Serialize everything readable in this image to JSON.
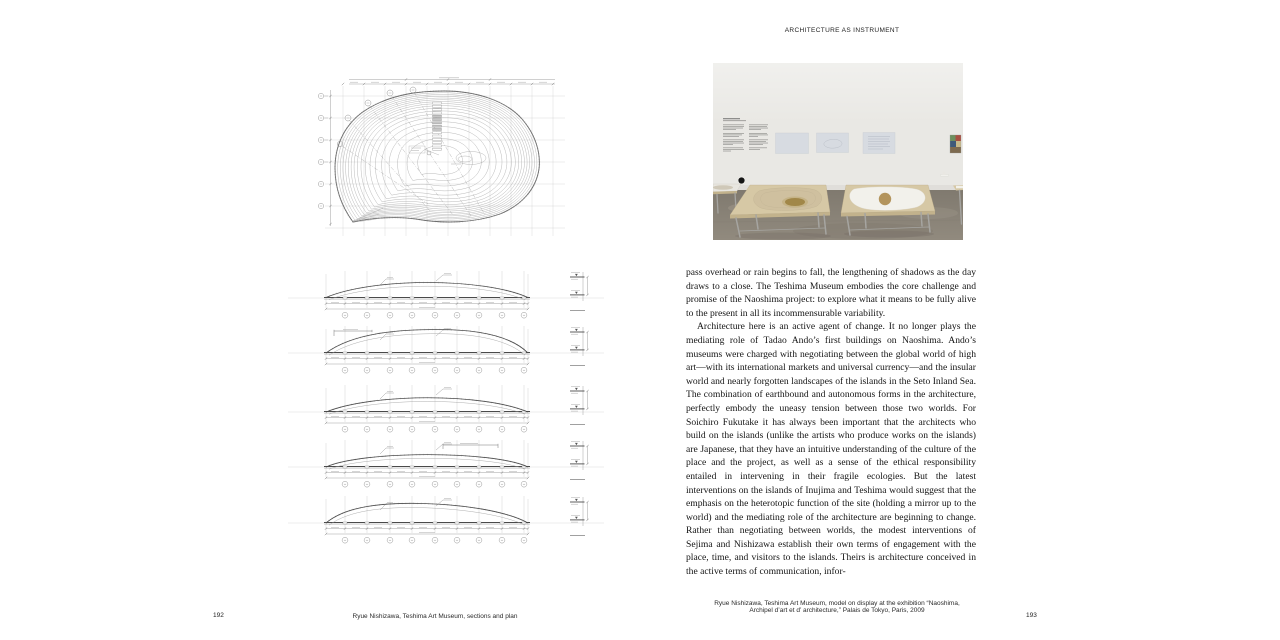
{
  "left_page": {
    "page_number": "192",
    "caption": "Ryue Nishizawa, Teshima Art Museum, sections and plan",
    "figures": {
      "plan_count": 1,
      "section_count": 5
    }
  },
  "right_page": {
    "running_head": "ARCHITECTURE AS INSTRUMENT",
    "page_number": "193",
    "photo_caption": {
      "line1": "Ryue Nishizawa, Teshima Art Museum, model on display at the exhibition “Naoshima,",
      "line2": "Archipel d’art et d’ architecture,” Palais de Tokyo, Paris, 2009"
    },
    "body": {
      "paragraph1": "pass overhead or rain begins to fall, the lengthening of shadows as the day draws to a close. The Teshima Museum embodies the core challenge and promise of the Naoshima project: to explore what it means to be fully alive to the present in all its incommensurable variability.",
      "paragraph2": "Architecture here is an active agent of change. It no longer plays the mediating role of Tadao Ando’s first buildings on Naoshima. Ando’s museums were charged with negotiating between the global world of high art—with its international markets and universal currency—and the insular world and nearly forgotten landscapes of the islands in the Seto Inland Sea. The combination of earthbound and autonomous forms in the architecture, perfectly embody the uneasy tension between those two worlds. For Soichiro Fukutake it has always been important that the architects who build on the islands (unlike the artists who produce works on the islands) are Japanese, that they have an intuitive understanding of the culture of the place and the project, as well as a sense of the ethical responsibility entailed in intervening in their fragile ecologies. But the latest interventions on the islands of Inujima and Teshima would suggest that the emphasis on the heterotopic function of the site (holding a mirror up to the world) and the mediating role of the architecture are beginning to change. Rather than negotiating between worlds, the modest interventions of Sejima and Nishizawa establish their own terms of engagement with the place, time, and visitors to the islands. Theirs is architecture conceived in the active terms of communication, infor-"
    }
  },
  "photo": {
    "colors": {
      "wall": "#e9e8e4",
      "wall_shade": "#d8d6d1",
      "floor": "#918a7e",
      "floor_light": "#a39b8f",
      "floor_dark": "#7f786e",
      "plywood": "#d6c8a5",
      "plywood_edge": "#c2b28c",
      "model_left": "#cfc09f",
      "model_left_spot": "#a18748",
      "model_right": "#f2f1eb",
      "model_right_spot": "#b3945c",
      "panel": "#d7dbe1",
      "metal": "#a6a5a1",
      "art1": "#6d8f5e",
      "art2": "#a84f42",
      "art3": "#3e5a7a",
      "art4": "#c7b98a",
      "art5": "#7d6a4f",
      "dot": "#151515"
    }
  },
  "drawings": {
    "ink": "#4a4a4a",
    "mid": "#8a8a8a",
    "light": "#9b9b9b",
    "grid": "#c9c9c9"
  }
}
